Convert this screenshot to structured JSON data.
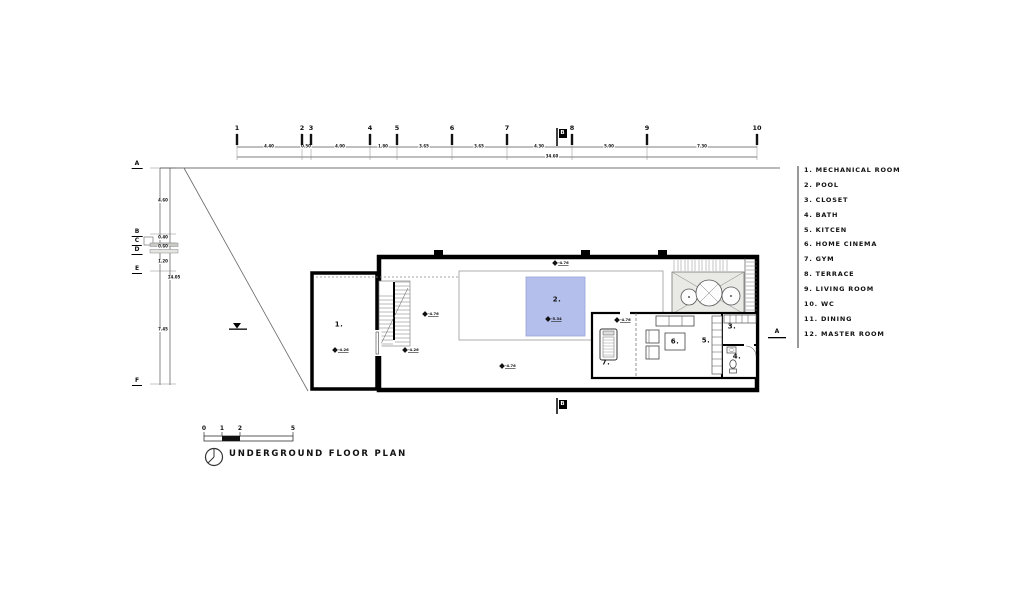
{
  "title": "UNDERGROUND FLOOR PLAN",
  "legend": {
    "items": [
      {
        "text": "1. MECHANICAL ROOM"
      },
      {
        "text": "2. POOL"
      },
      {
        "text": "3. CLOSET"
      },
      {
        "text": "4. BATH"
      },
      {
        "text": "5. KITCEN"
      },
      {
        "text": "6. HOME CINEMA"
      },
      {
        "text": "7. GYM"
      },
      {
        "text": "8. TERRACE"
      },
      {
        "text": "9. LIVING ROOM"
      },
      {
        "text": "10. WC"
      },
      {
        "text": "11. DINING"
      },
      {
        "text": "12. MASTER ROOM"
      }
    ]
  },
  "grid_top": {
    "numbers": [
      "1",
      "2",
      "3",
      "4",
      "5",
      "6",
      "7",
      "8",
      "9",
      "10"
    ],
    "dims": [
      "4.40",
      "0.50",
      "4.00",
      "1.80",
      "3.65",
      "3.65",
      "4.30",
      "5.00",
      "7.30"
    ],
    "total": "34.60"
  },
  "grid_left": {
    "letters": [
      "A",
      "B",
      "C",
      "D",
      "E",
      "F"
    ],
    "dims": [
      "4.60",
      "0.40",
      "0.60",
      "1.20",
      "7.45"
    ],
    "total": "14.05"
  },
  "sections": {
    "top": "B",
    "bottom": "B",
    "right": "A"
  },
  "rooms": [
    {
      "label": "1."
    },
    {
      "label": "2."
    },
    {
      "label": "3."
    },
    {
      "label": "4."
    },
    {
      "label": "5."
    },
    {
      "label": "6."
    },
    {
      "label": "7."
    }
  ],
  "levels": [
    {
      "value": "-4.26"
    },
    {
      "value": "-4.26"
    },
    {
      "value": "-4.76"
    },
    {
      "value": "-4.76"
    },
    {
      "value": "-4.76"
    },
    {
      "value": "-4.76"
    },
    {
      "value": "-5.34"
    }
  ],
  "scalebar": {
    "labels": [
      "0",
      "1",
      "2",
      "5"
    ]
  },
  "colors": {
    "pool": "#b5bfec",
    "equipment_pad": "#e9e9e6",
    "wall": "#000000"
  }
}
